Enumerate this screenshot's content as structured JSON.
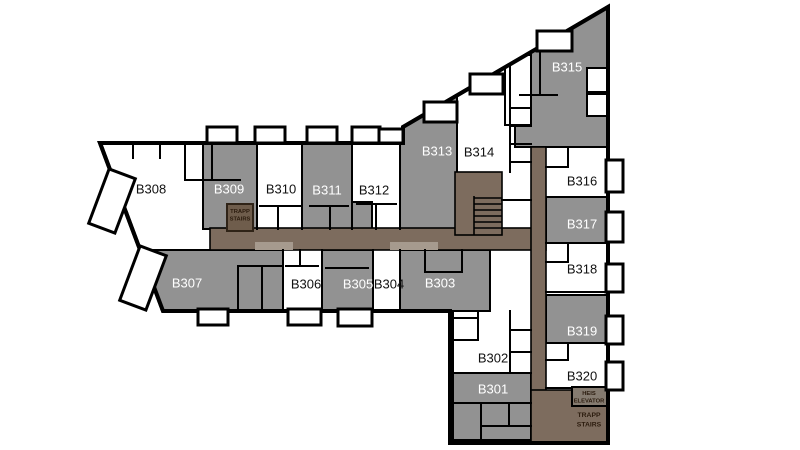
{
  "floor_plan": {
    "canvas": {
      "width": 800,
      "height": 450
    },
    "colors": {
      "background": "#ffffff",
      "wall": "#000000",
      "unit_gray": "#929292",
      "unit_white": "#ffffff",
      "corridor": "#7d6c5e",
      "corridor_light": "#a69a8e",
      "stair_box_fill": "#6f5d4c",
      "stair_box_border": "#2f2317",
      "elevator_box_fill": "#857b70",
      "label_dark": "#111111",
      "label_light": "#ffffff",
      "service_text": "#2b1b0d"
    },
    "outline_points": "100,143 403,143 403,127 608,7 608,443 450,443 450,311 163,311",
    "units": [
      {
        "id": "B301",
        "label": "B301",
        "x": 493,
        "y": 389,
        "tone": "gray",
        "rect": [
          453,
          373,
          78,
          30
        ]
      },
      {
        "id": "B302",
        "label": "B302",
        "x": 493,
        "y": 358,
        "tone": "white"
      },
      {
        "id": "B303",
        "label": "B303",
        "x": 440,
        "y": 283,
        "tone": "gray",
        "rect": [
          400,
          250,
          90,
          61
        ]
      },
      {
        "id": "B304",
        "label": "B304",
        "x": 389,
        "y": 284,
        "tone": "white"
      },
      {
        "id": "B305",
        "label": "B305",
        "x": 358,
        "y": 284,
        "tone": "gray",
        "rect": [
          322,
          250,
          51,
          61
        ]
      },
      {
        "id": "B306",
        "label": "B306",
        "x": 306,
        "y": 284,
        "tone": "white"
      },
      {
        "id": "B307",
        "label": "B307",
        "x": 187,
        "y": 283,
        "tone": "gray",
        "poly": "138,250 283,250 283,311 163,311"
      },
      {
        "id": "B308",
        "label": "B308",
        "x": 151,
        "y": 189,
        "tone": "white"
      },
      {
        "id": "B309",
        "label": "B309",
        "x": 229,
        "y": 189,
        "tone": "gray",
        "rect": [
          203,
          143,
          54,
          86
        ]
      },
      {
        "id": "B310",
        "label": "B310",
        "x": 281,
        "y": 189,
        "tone": "white"
      },
      {
        "id": "B311",
        "label": "B311",
        "x": 327,
        "y": 190,
        "tone": "gray",
        "rect": [
          302,
          143,
          50,
          86
        ]
      },
      {
        "id": "B312",
        "label": "B312",
        "x": 374,
        "y": 190,
        "tone": "white"
      },
      {
        "id": "B313",
        "label": "B313",
        "x": 437,
        "y": 151,
        "tone": "gray",
        "rect": [
          400,
          60,
          57,
          169
        ]
      },
      {
        "id": "B314",
        "label": "B314",
        "x": 479,
        "y": 152,
        "tone": "white"
      },
      {
        "id": "B315",
        "label": "B315",
        "x": 567,
        "y": 67,
        "tone": "gray",
        "rect": [
          515,
          0,
          93,
          147
        ]
      },
      {
        "id": "B316",
        "label": "B316",
        "x": 582,
        "y": 181,
        "tone": "white"
      },
      {
        "id": "B317",
        "label": "B317",
        "x": 582,
        "y": 224,
        "tone": "gray",
        "rect": [
          546,
          197,
          62,
          46
        ]
      },
      {
        "id": "B318",
        "label": "B318",
        "x": 582,
        "y": 269,
        "tone": "white"
      },
      {
        "id": "B319",
        "label": "B319",
        "x": 582,
        "y": 331,
        "tone": "gray",
        "rect": [
          546,
          295,
          62,
          48
        ]
      },
      {
        "id": "B320",
        "label": "B320",
        "x": 582,
        "y": 376,
        "tone": "white"
      }
    ],
    "extra_gray_blocks": [
      {
        "id": "rooms-below-b301",
        "rect": [
          453,
          403,
          78,
          37
        ]
      },
      {
        "id": "b311-annex",
        "rect": [
          352,
          202,
          20,
          27
        ]
      }
    ],
    "white_subrooms": [
      {
        "id": "b315-room-1",
        "rect": [
          587,
          68,
          20,
          24
        ]
      },
      {
        "id": "b315-room-2",
        "rect": [
          587,
          94,
          20,
          22
        ]
      },
      {
        "id": "b315-room-3",
        "rect": [
          505,
          55,
          26,
          70
        ]
      }
    ],
    "corridors": [
      {
        "id": "corridor-horizontal",
        "rect": [
          210,
          228,
          336,
          22
        ]
      },
      {
        "id": "corridor-vertical",
        "rect": [
          531,
          147,
          15,
          296
        ]
      },
      {
        "id": "stairs-southeast",
        "rect": [
          531,
          390,
          77,
          53
        ]
      },
      {
        "id": "stairwell-central",
        "rect": [
          455,
          172,
          47,
          63
        ]
      }
    ],
    "corridor_light_patches": [
      [
        255,
        242,
        38,
        8
      ],
      [
        390,
        242,
        48,
        8
      ]
    ],
    "service_boxes": [
      {
        "id": "stair-box-west",
        "rect": [
          227,
          204,
          26,
          27
        ],
        "fill": "stair_box_fill",
        "border": "stair_box_border"
      },
      {
        "id": "elevator-box",
        "rect": [
          572,
          387,
          35,
          19
        ],
        "fill": "elevator_box_fill",
        "border": "wall"
      }
    ],
    "service_labels": [
      {
        "id": "trapp-stairs-west",
        "lines": [
          "TRAPP",
          "STAIRS"
        ],
        "x": 240,
        "y": 213,
        "dy": 7.5,
        "size": 5.8
      },
      {
        "id": "heis-elevator",
        "lines": [
          "HEIS",
          "ELEVATOR"
        ],
        "x": 589,
        "y": 395,
        "dy": 7.5,
        "size": 5.8
      },
      {
        "id": "trapp-stairs-south",
        "lines": [
          "TRAPP",
          "STAIRS"
        ],
        "x": 589,
        "y": 417,
        "dy": 9.5,
        "size": 6.8
      }
    ],
    "balconies": [
      {
        "rect": [
          207,
          127,
          30,
          16
        ]
      },
      {
        "rect": [
          255,
          127,
          30,
          16
        ]
      },
      {
        "rect": [
          307,
          127,
          30,
          16
        ]
      },
      {
        "rect": [
          352,
          127,
          28,
          16
        ]
      },
      {
        "rect": [
          379,
          129,
          24,
          14
        ]
      },
      {
        "rect": [
          424,
          102,
          33,
          20
        ]
      },
      {
        "rect": [
          470,
          74,
          33,
          20
        ]
      },
      {
        "rect": [
          537,
          31,
          35,
          20
        ]
      },
      {
        "rect": [
          606,
          160,
          17,
          32
        ]
      },
      {
        "rect": [
          606,
          212,
          17,
          30
        ]
      },
      {
        "rect": [
          606,
          264,
          17,
          28
        ]
      },
      {
        "rect": [
          606,
          316,
          17,
          28
        ]
      },
      {
        "rect": [
          606,
          362,
          17,
          28
        ]
      },
      {
        "rect": [
          198,
          309,
          30,
          16
        ]
      },
      {
        "rect": [
          288,
          309,
          33,
          16
        ]
      },
      {
        "rect": [
          338,
          309,
          34,
          17
        ]
      },
      {
        "rot": {
          "cx": 112,
          "cy": 201,
          "w": 28,
          "h": 58,
          "angle": 20.6
        }
      },
      {
        "rot": {
          "cx": 143,
          "cy": 278,
          "w": 28,
          "h": 58,
          "angle": 20.6
        }
      }
    ],
    "walls": [
      [
        203,
        143,
        203,
        229
      ],
      [
        257,
        143,
        257,
        229
      ],
      [
        302,
        143,
        302,
        229
      ],
      [
        352,
        143,
        352,
        229
      ],
      [
        400,
        143,
        400,
        229
      ],
      [
        510,
        60,
        510,
        172
      ],
      [
        510,
        108,
        531,
        108
      ],
      [
        510,
        126,
        531,
        126
      ],
      [
        510,
        144,
        531,
        144
      ],
      [
        510,
        162,
        531,
        162
      ],
      [
        502,
        200,
        531,
        200
      ],
      [
        283,
        250,
        283,
        311
      ],
      [
        322,
        250,
        322,
        311
      ],
      [
        373,
        250,
        373,
        311
      ],
      [
        400,
        250,
        400,
        311
      ],
      [
        546,
        147,
        608,
        147
      ],
      [
        546,
        243,
        608,
        243
      ],
      [
        546,
        292,
        608,
        292
      ],
      [
        546,
        388,
        608,
        388
      ],
      [
        453,
        311,
        453,
        443
      ],
      [
        510,
        311,
        510,
        373
      ],
      [
        453,
        373,
        531,
        373
      ],
      [
        453,
        403,
        531,
        403
      ],
      [
        133,
        143,
        133,
        158
      ],
      [
        160,
        143,
        160,
        158
      ],
      [
        185,
        143,
        185,
        180
      ],
      [
        212,
        143,
        212,
        180
      ],
      [
        185,
        180,
        240,
        180
      ],
      [
        260,
        206,
        300,
        206
      ],
      [
        278,
        206,
        278,
        229
      ],
      [
        310,
        206,
        348,
        206
      ],
      [
        330,
        206,
        330,
        229
      ],
      [
        357,
        204,
        396,
        204
      ],
      [
        376,
        204,
        376,
        229
      ],
      [
        286,
        266,
        318,
        266
      ],
      [
        300,
        250,
        300,
        266
      ],
      [
        326,
        268,
        368,
        268
      ],
      [
        238,
        266,
        238,
        311
      ],
      [
        262,
        266,
        262,
        311
      ],
      [
        238,
        266,
        283,
        266
      ],
      [
        425,
        250,
        425,
        272
      ],
      [
        425,
        272,
        462,
        272
      ],
      [
        462,
        250,
        462,
        272
      ],
      [
        455,
        318,
        478,
        318
      ],
      [
        478,
        311,
        478,
        340
      ],
      [
        453,
        340,
        478,
        340
      ],
      [
        510,
        330,
        531,
        330
      ],
      [
        510,
        352,
        531,
        352
      ],
      [
        568,
        147,
        568,
        167
      ],
      [
        546,
        167,
        568,
        167
      ],
      [
        568,
        245,
        568,
        262
      ],
      [
        546,
        262,
        568,
        262
      ],
      [
        568,
        343,
        568,
        360
      ],
      [
        546,
        360,
        568,
        360
      ],
      [
        481,
        403,
        481,
        440
      ],
      [
        509,
        403,
        509,
        426
      ],
      [
        481,
        426,
        531,
        426
      ],
      [
        540,
        52,
        540,
        95
      ],
      [
        520,
        95,
        557,
        95
      ]
    ],
    "stair_treads": {
      "x1": 474,
      "x2": 502,
      "ys": [
        198,
        204,
        210,
        216,
        222,
        228
      ],
      "divider": [
        474,
        196,
        474,
        235
      ]
    },
    "label_font_size": 13
  }
}
